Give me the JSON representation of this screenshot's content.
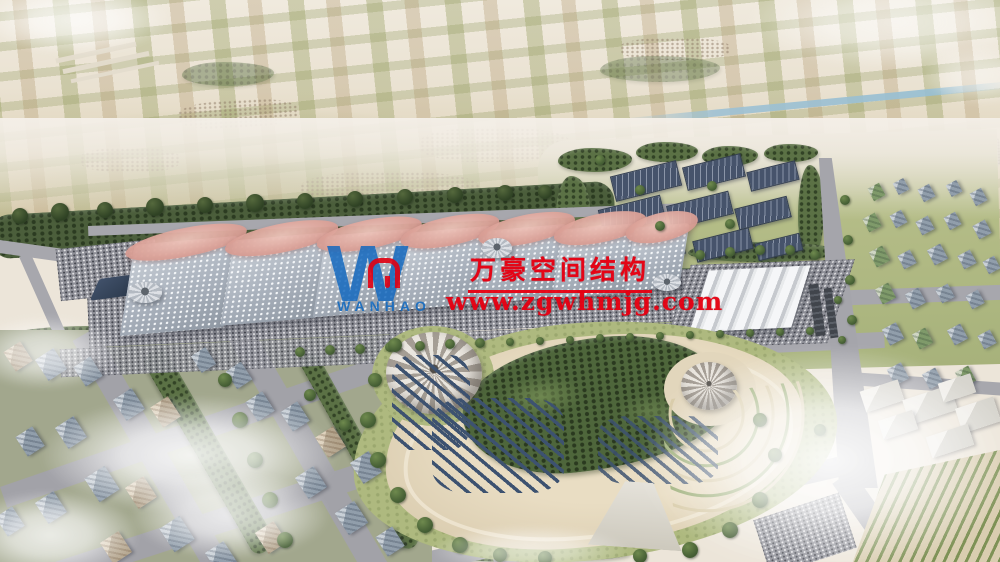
{
  "watermark": {
    "logo_letter": "W",
    "logo_subtext": "WANHAO",
    "company_cn": "万豪空间结构",
    "website": "www.zgwhmjg.com",
    "colors": {
      "text_red": "#e80012",
      "logo_blue": "#1469be"
    }
  }
}
